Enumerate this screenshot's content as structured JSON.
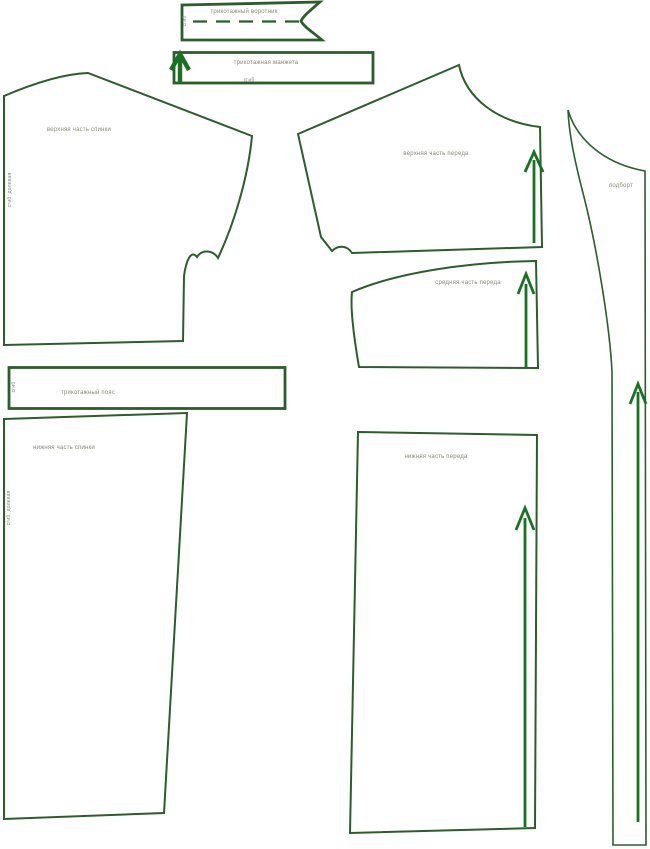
{
  "colors": {
    "outline": "#2d5c2d",
    "arrow": "#1c7023",
    "label": "#8a8878",
    "background": "#ffffff"
  },
  "pieces": {
    "collar": {
      "label": "трикотажный воротник",
      "fold": "сгиб"
    },
    "cuff": {
      "label": "трикотажная манжета",
      "fold": "сгиб"
    },
    "upper_back": {
      "label": "верхняя часть спинки",
      "fold": "сгиб, долевая"
    },
    "upper_front": {
      "label": "верхняя часть переда"
    },
    "middle_front": {
      "label": "средняя часть переда"
    },
    "facing": {
      "label": "подборт"
    },
    "waistband": {
      "label": "трикотажный пояс",
      "fold": "сгиб"
    },
    "lower_back": {
      "label": "нижняя часть спинки",
      "fold": "сгиб, долевая"
    },
    "lower_front": {
      "label": "нижняя часть переда"
    }
  }
}
